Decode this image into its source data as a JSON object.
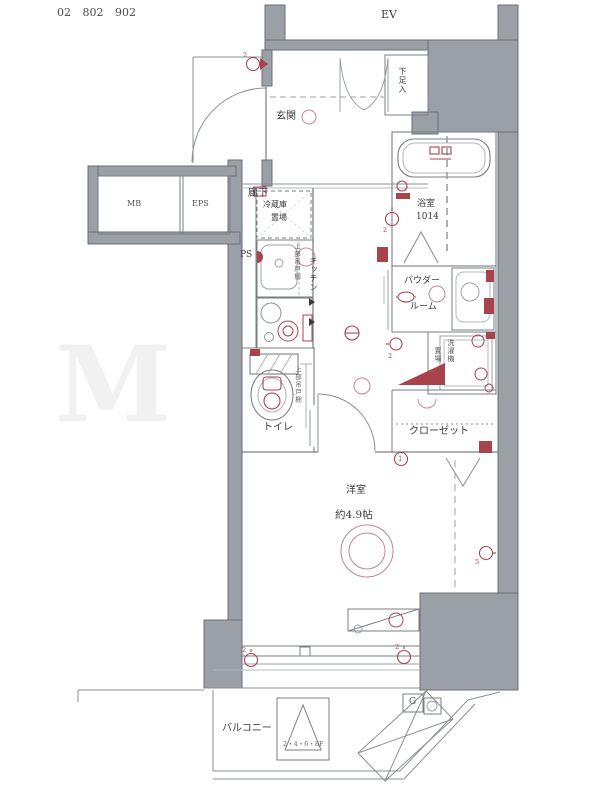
{
  "header": {
    "unit_numbers": "02  802  902"
  },
  "colors": {
    "wall_fill": "#9ba0a7",
    "wall_edge": "#6b7076",
    "line": "#7a7f85",
    "light_line": "#b4b8bd",
    "accent_red": "#a8434c",
    "soft_red": "#c2878e"
  },
  "rooms": {
    "elevator": "EV",
    "entrance": "玄関",
    "shoe_cabinet": "下足入",
    "hallway": "廊下",
    "pipe_space": "PS",
    "meter_box": "MB",
    "eps": "EPS",
    "fridge_line1": "冷蔵庫",
    "fridge_line2": "置場",
    "kitchen": "キッチン",
    "upper_cabinet_kitchen": "上部吊戸棚",
    "bath": "浴室",
    "bath_size": "1014",
    "powder_line1": "パウダー",
    "powder_line2": "ルーム",
    "laundry_line1": "洗濯機",
    "laundry_line2": "置場",
    "upper_cabinet_toilet": "上部吊戸棚",
    "toilet": "トイレ",
    "closet": "クローゼット",
    "main_room": "洋室",
    "main_room_size": "約4.9帖",
    "balcony": "バルコニー"
  },
  "annotations": {
    "hatch_floors": "2・4・6・8F",
    "gas_meter": "G",
    "circled_one": "1",
    "outlet_two": "2",
    "outlet_five": "5",
    "watermark": "M"
  }
}
